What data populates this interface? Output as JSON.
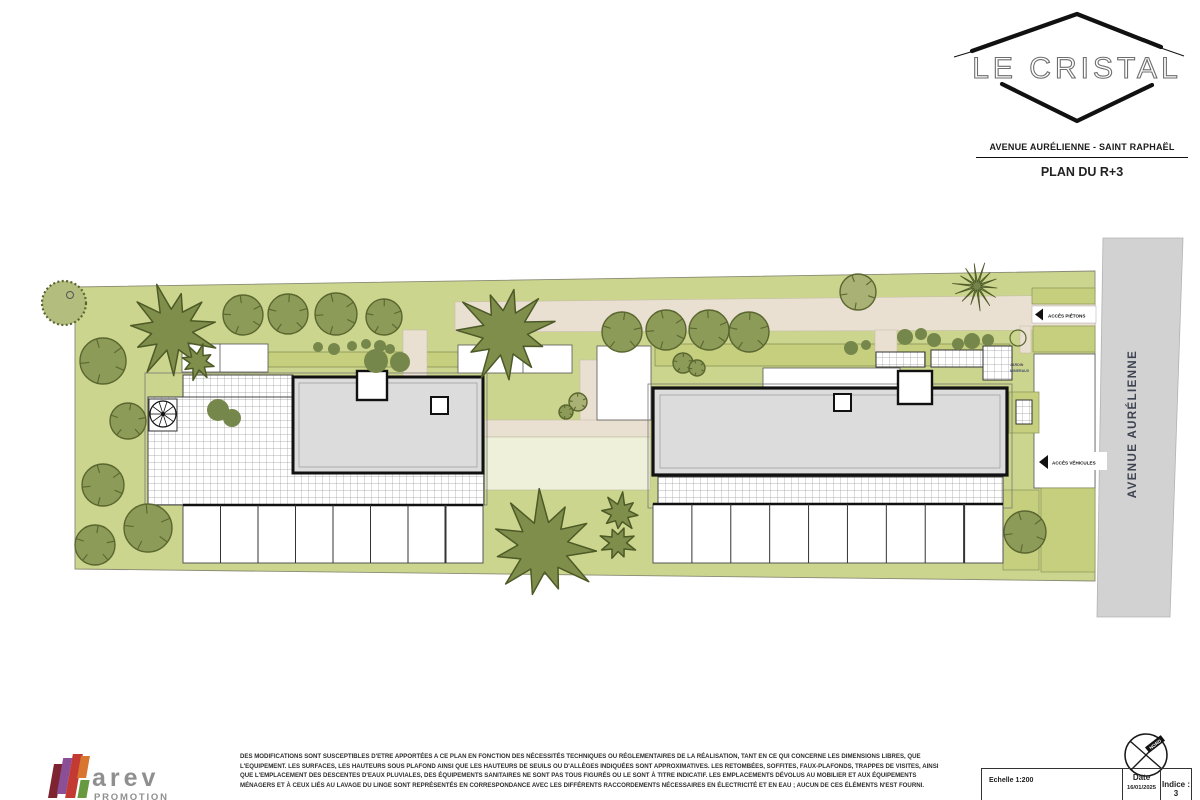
{
  "header": {
    "logo_title": "LE CRISTAL",
    "address_line": "AVENUE AURÉLIENNE - SAINT RAPHAËL",
    "plan_title": "PLAN DU R+3"
  },
  "plan": {
    "street_label": "AVENUE AURÉLIENNE",
    "access_pedestrian_label": "ACCÈS PIÉTONS",
    "access_vehicle_label": "ACCÈS VÉHICULES",
    "garden_label_line1": "JARDIN",
    "garden_label_line2": "MINERAUX",
    "colors": {
      "site_green": "#ccd58d",
      "hedge_green": "#c5cf7e",
      "tree_green": "#8d9b58",
      "tree_dark": "#5a662f",
      "tree_light": "#a9b274",
      "palm_green": "#7f8f4b",
      "palm_dark": "#4d5a27",
      "shrub_green": "#75874a",
      "path_beige": "#eae0d1",
      "pale_green": "#eef0da",
      "road_gray": "#d2d2d2",
      "roof_gray": "#dcdcdc",
      "ink": "#111111"
    },
    "round_trees": [
      {
        "x": 243,
        "y": 315,
        "r": 20
      },
      {
        "x": 288,
        "y": 314,
        "r": 20
      },
      {
        "x": 336,
        "y": 314,
        "r": 21
      },
      {
        "x": 384,
        "y": 317,
        "r": 18
      },
      {
        "x": 103,
        "y": 361,
        "r": 23
      },
      {
        "x": 128,
        "y": 421,
        "r": 18
      },
      {
        "x": 103,
        "y": 485,
        "r": 21
      },
      {
        "x": 95,
        "y": 545,
        "r": 20
      },
      {
        "x": 148,
        "y": 528,
        "r": 24
      },
      {
        "x": 622,
        "y": 332,
        "r": 20
      },
      {
        "x": 666,
        "y": 330,
        "r": 20
      },
      {
        "x": 709,
        "y": 330,
        "r": 20
      },
      {
        "x": 749,
        "y": 332,
        "r": 20
      },
      {
        "x": 858,
        "y": 292,
        "r": 18,
        "light": true
      },
      {
        "x": 1025,
        "y": 532,
        "r": 21
      },
      {
        "x": 578,
        "y": 402,
        "r": 9,
        "light": true
      },
      {
        "x": 566,
        "y": 412,
        "r": 7
      },
      {
        "x": 683,
        "y": 363,
        "r": 10
      },
      {
        "x": 697,
        "y": 368,
        "r": 8
      }
    ],
    "corner_tree": {
      "x": 64,
      "y": 303,
      "r": 22
    },
    "burst_tree": {
      "x": 977,
      "y": 286,
      "r": 24
    },
    "palm_trees": [
      {
        "x": 172,
        "y": 330,
        "r": 46
      },
      {
        "x": 198,
        "y": 362,
        "r": 18
      },
      {
        "x": 505,
        "y": 333,
        "r": 50
      },
      {
        "x": 543,
        "y": 547,
        "r": 56
      },
      {
        "x": 620,
        "y": 513,
        "r": 20
      },
      {
        "x": 618,
        "y": 543,
        "r": 19
      }
    ],
    "shrubs": [
      {
        "x": 318,
        "y": 347,
        "r": 5
      },
      {
        "x": 334,
        "y": 349,
        "r": 6
      },
      {
        "x": 352,
        "y": 346,
        "r": 5
      },
      {
        "x": 366,
        "y": 344,
        "r": 5
      },
      {
        "x": 380,
        "y": 346,
        "r": 6
      },
      {
        "x": 390,
        "y": 349,
        "r": 5
      },
      {
        "x": 376,
        "y": 361,
        "r": 12
      },
      {
        "x": 400,
        "y": 362,
        "r": 10
      },
      {
        "x": 218,
        "y": 410,
        "r": 11
      },
      {
        "x": 232,
        "y": 418,
        "r": 9
      },
      {
        "x": 851,
        "y": 348,
        "r": 7
      },
      {
        "x": 866,
        "y": 345,
        "r": 5
      },
      {
        "x": 905,
        "y": 337,
        "r": 8
      },
      {
        "x": 921,
        "y": 334,
        "r": 6
      },
      {
        "x": 934,
        "y": 340,
        "r": 7
      },
      {
        "x": 958,
        "y": 344,
        "r": 6
      },
      {
        "x": 972,
        "y": 341,
        "r": 8
      },
      {
        "x": 988,
        "y": 340,
        "r": 6
      },
      {
        "x": 1018,
        "y": 338,
        "r": 8,
        "outline": true
      }
    ],
    "stall_rows": [
      {
        "x": 183,
        "y": 505,
        "w": 300,
        "h": 58,
        "n": 8
      },
      {
        "x": 653,
        "y": 504,
        "w": 350,
        "h": 59,
        "n": 9
      }
    ],
    "spiral": {
      "x": 163,
      "y": 414,
      "r": 13
    }
  },
  "footer": {
    "disclaimer_lines": [
      "DES MODIFICATIONS SONT SUSCEPTIBLES D'ETRE APPORTÉES A CE PLAN EN FONCTION DES NÉCESSITÉS TECHNIQUES OU RÉGLEMENTAIRES DE LA RÉALISATION, TANT EN CE QUI CONCERNE LES DIMENSIONS LIBRES, QUE",
      "L'EQUIPEMENT. LES SURFACES, LES HAUTEURS SOUS PLAFOND AINSI QUE LES HAUTEURS DE SEUILS OU D'ALLÈGES INDIQUÉES SONT APPROXIMATIVES. LES RETOMBÉES, SOFFITES, FAUX-PLAFONDS, TRAPPES DE VISITES, AINSI",
      "QUE L'EMPLACEMENT DES DESCENTES D'EAUX PLUVIALES, DES ÉQUIPEMENTS SANITAIRES NE SONT PAS TOUS FIGURÉS OU LE SONT À TITRE INDICATIF. LES EMPLACEMENTS DÉVOLUS AU MOBILIER ET AUX ÉQUIPEMENTS",
      "MÉNAGERS ET À CEUX LIÉS AU LAVAGE DU LINGE SONT REPRÉSENTÉS EN CORRESPONDANCE AVEC LES DIFFÉRENTS RACCORDEMENTS NÉCESSAIRES EN ÉLECTRICITÉ ET EN EAU ; AUCUN DE CES ÉLÉMENTS N'EST FOURNI.",
      ""
    ],
    "logo_text": "arev",
    "logo_subtext": "PROMOTION",
    "logo_bar_colors": [
      "#7d2430",
      "#8a4f97",
      "#c23a31",
      "#d8752f",
      "#679a40"
    ],
    "scale_label": "Echelle 1:200",
    "date_label": "Date",
    "date_value": "16/01/2025",
    "index_label": "Indice : 3",
    "north_label": "NORD"
  }
}
